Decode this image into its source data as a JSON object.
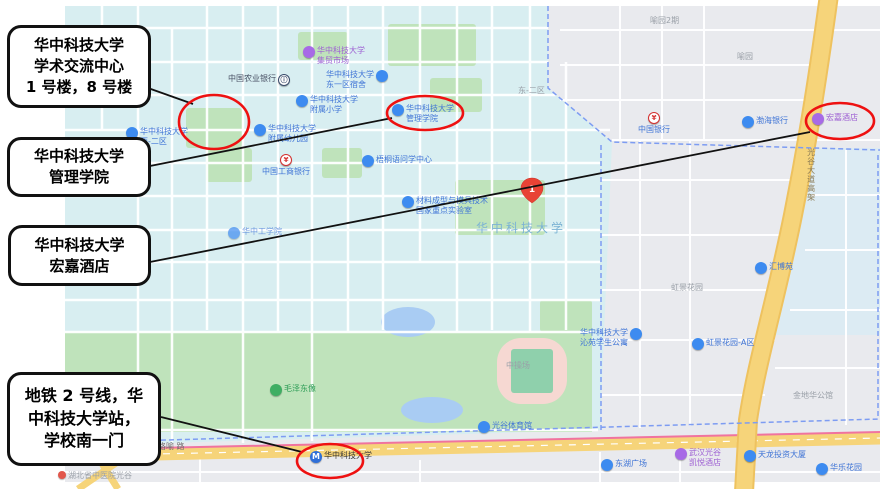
{
  "figure": {
    "type": "annotated-map",
    "subject": "华中科技大学校区地图标注"
  },
  "palette": {
    "campus_bg": "#d8eef1",
    "urban_bg": "#e9eaee",
    "park_green": "#bfe3bb",
    "water_blue": "#a9ccf3",
    "road_yellow": "#f6d47a",
    "metro_line_pink": "#f0739f",
    "district_boundary_blue": "#7d9cf2",
    "annotation_red": "#ee1111",
    "annotation_black": "#111111",
    "poi_blue": "#3d8bf0",
    "poi_purple": "#a76ae6",
    "poi_green": "#3fae63"
  },
  "callouts": [
    {
      "text": "华中科技大学\n学术交流中心\n1 号楼，8 号楼"
    },
    {
      "text": "华中科技大学\n管理学院"
    },
    {
      "text": "华中科技大学\n宏嘉酒店"
    },
    {
      "text": "地铁 2 号线，华\n中科技大学站，\n学校南一门"
    }
  ],
  "map": {
    "marker": {
      "label": "1"
    },
    "icons": {
      "metro_glyph": "M",
      "bank_glyph": "¥",
      "abc_glyph": "ⓘ"
    },
    "pois": [
      {
        "name": "中国农业银行"
      },
      {
        "name": "华中科技大学\n集贸市场"
      },
      {
        "name": "华中科技大学\n东一区宿舍"
      },
      {
        "name": "东-二区"
      },
      {
        "name": "华中科技大学\n附属小学"
      },
      {
        "name": "华中科技大学\n管理学院"
      },
      {
        "name": "华中科技大学\n西-二区"
      },
      {
        "name": "华中科技大学\n附属幼儿园"
      },
      {
        "name": "中国工商银行"
      },
      {
        "name": "梧桐语问学中心"
      },
      {
        "name": "材料成型与模具技术\n国家重点实验室"
      },
      {
        "name": "华中科技大学"
      },
      {
        "name": "华中工学院"
      },
      {
        "name": "喻园2期"
      },
      {
        "name": "喻园"
      },
      {
        "name": "中国银行"
      },
      {
        "name": "渤海银行"
      },
      {
        "name": "宏嘉酒店"
      },
      {
        "name": "光谷大道高架"
      },
      {
        "name": "汇博苑"
      },
      {
        "name": "虹景花园"
      },
      {
        "name": "华中科技大学\n沁苑学生公寓"
      },
      {
        "name": "虹景花园-A区"
      },
      {
        "name": "金地华公馆"
      },
      {
        "name": "中操场"
      },
      {
        "name": "毛泽东像"
      },
      {
        "name": "光谷体育馆"
      },
      {
        "name": "珞喻 路"
      },
      {
        "name": "湖北省中医院光谷"
      },
      {
        "name": "东湖广场"
      },
      {
        "name": "武汉光谷\n凯悦酒店"
      },
      {
        "name": "天龙投资大厦"
      },
      {
        "name": "华乐花园"
      },
      {
        "name": "华中科技大学"
      }
    ]
  }
}
